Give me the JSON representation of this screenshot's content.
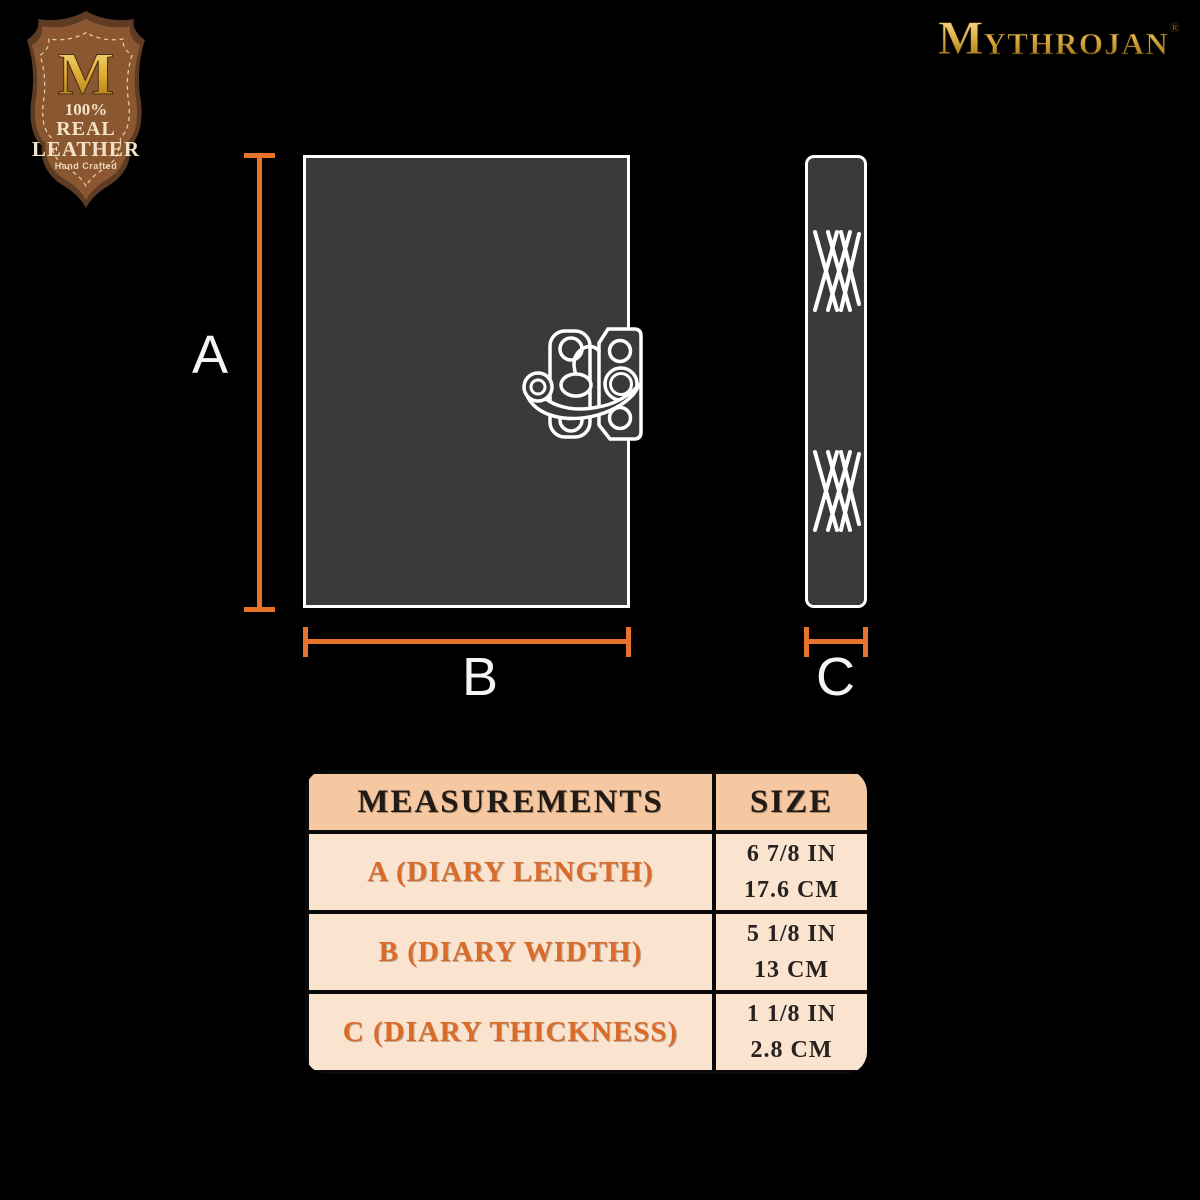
{
  "brand": {
    "name": "MYTHROJAN",
    "registered": "®"
  },
  "badge": {
    "monogram": "M",
    "line_percent": "100%",
    "line_real": "REAL",
    "line_leather": "LEATHER",
    "subtitle": "Hand Crafted"
  },
  "diagram": {
    "length_label": "A",
    "width_label": "B",
    "thickness_label": "C"
  },
  "table": {
    "headers": [
      "MEASUREMENTS",
      "SIZE"
    ],
    "rows": [
      {
        "label": "A (DIARY LENGTH)",
        "inches": "6 7/8 IN",
        "cm": "17.6 CM"
      },
      {
        "label": "B (DIARY WIDTH)",
        "inches": "5 1/8 IN",
        "cm": "13 CM"
      },
      {
        "label": "C (DIARY THICKNESS)",
        "inches": "1 1/8 IN",
        "cm": "2.8 CM"
      }
    ]
  },
  "colors": {
    "accent_orange": "#E8742B",
    "panel_gray": "#3A3A3C",
    "panel_outline": "#FFFFFF",
    "gold": "#E3B44B",
    "badge_brown": "#8B5731",
    "badge_border": "#5E3B23",
    "badge_cream": "#F2E3C8",
    "table_header_bg": "#F6C8A1",
    "table_row_bg": "#FAE4CF",
    "table_label_orange": "#DB6B28",
    "table_text": "#272120",
    "background": "#000000"
  }
}
